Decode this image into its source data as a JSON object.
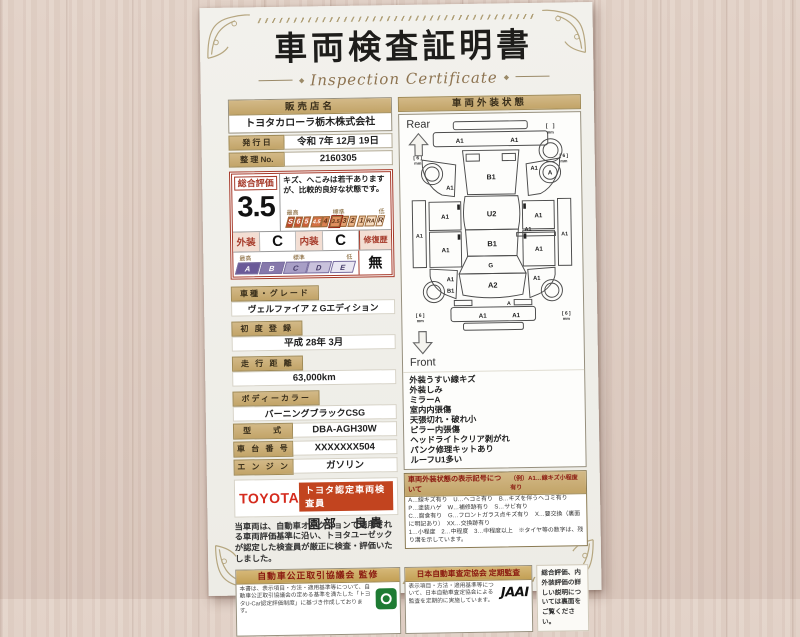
{
  "page": {
    "title_ja": "車両検査証明書",
    "title_en": "Inspection Certificate",
    "ornament": "◆"
  },
  "seller": {
    "label": "販売店名",
    "name": "トヨタカローラ栃木株式会社"
  },
  "issue": {
    "label": "発 行 日",
    "value": "令和 7年 12月 19日"
  },
  "serial": {
    "label": "整 理 No.",
    "value": "2160305"
  },
  "rating": {
    "label": "総合評価",
    "score": "3.5",
    "comment": "キズ、へこみは若干ありますが、比較的良好な状態です。",
    "legend_high": "最高",
    "legend_mid": "標準",
    "legend_low": "低",
    "scale": [
      "S",
      "6",
      "5",
      "4.5",
      "4",
      "3.5",
      "3",
      "2",
      "1",
      "RA",
      "R"
    ],
    "selected": "3.5",
    "exterior_label": "外装",
    "exterior_grade": "C",
    "interior_label": "内装",
    "interior_grade": "C",
    "repair_label": "修復歴",
    "repair_value": "無",
    "grades": [
      "A",
      "B",
      "C",
      "D",
      "E"
    ]
  },
  "details": [
    {
      "label": "車種・グレード",
      "value": "ヴェルファイア Z Gエディション"
    },
    {
      "label": "初 度 登 録",
      "value": "平成 28年 3月"
    },
    {
      "label": "走 行 距 離",
      "value": "63,000km"
    },
    {
      "label": "ボディーカラー",
      "value": "バーニングブラックCSG"
    },
    {
      "label": "型　　式",
      "value": "DBA-AGH30W"
    },
    {
      "label": "車 台 番 号",
      "value": "XXXXXXX504"
    },
    {
      "label": "エ ン ジ ン",
      "value": "ガソリン"
    }
  ],
  "inspector": {
    "brand": "TOYOTA",
    "badge": "トヨタ認定車両検査員",
    "name": "園部　良貴"
  },
  "disclaimer": "当車両は、自動車オークションで適用される車両評価基準に沿い、トヨタユーゼックが認定した検査員が厳正に検査・評価いたしました。",
  "exterior_panel": {
    "header": "車両外装状態",
    "rear_label": "Rear",
    "front_label": "Front",
    "spare_tire_note": "[　]",
    "tire_note": "[ 6 ]",
    "mm": "mm",
    "labels": {
      "rear_bumper_left": "A1",
      "rear_bumper_right": "A1",
      "back_door": "B1",
      "left_quarter": "A1",
      "right_quarter": "A1",
      "rear_right_tire": "A",
      "left_sill": "A1",
      "left_door_rear": "A1",
      "left_door_front": "A1",
      "right_door_rear": "A1",
      "right_door_front": "A1",
      "right_sill": "A1",
      "side_molding": "A1",
      "roof": "U2",
      "roof_rear": "B1",
      "windshield": "G",
      "hood": "A2",
      "left_fender": "A1",
      "left_front_corner": "B1",
      "right_fender": "A1",
      "front_mark": "A",
      "front_bumper_left": "A1",
      "front_bumper_right": "A1"
    },
    "conditions": [
      "外装うすい線キズ",
      "外装しみ",
      "ミラーA",
      "室内内張傷",
      "天張切れ・破れ小",
      "ピラー内張傷",
      "ヘッドライトクリア剥がれ",
      "パンク修理キットあり",
      "ルーフU1多い"
    ],
    "legend": {
      "title": "車両外装状態の表示記号について",
      "example": "（例）A1…線キズ小程度有り",
      "lines": [
        "A…線キズ有り　U…ヘコミ有り　B…キズを伴うヘコミ有り　P…塗装ハゲ　W…補修跡有り　S…サビ有り",
        "C…腐食有り　G…フロントガラス点キズ有り　X…要交換（裏面に明記あり）　XX…交換跡有り",
        "1…小程度　2…中程度　3…中程度以上　※タイヤ等の数字は、残り溝を示しています。"
      ]
    }
  },
  "footer": {
    "fair_trade": {
      "title": "自動車公正取引協議会 監修",
      "body": "本書は、表示項目・方法・適用基準等について、自動車公正取引協議会の定める基準を満たした「トヨタU-Car認定評価制度」に基づき作成しております。"
    },
    "jaai": {
      "title": "日本自動車査定協会 定期監査",
      "body": "表示項目・方法・適用基準等について、日本自動車査定協会による監査を定期的に実施しています。",
      "logo": "JAAI"
    },
    "note": "総合評価、内外装評価の詳しい説明については裏面をご覧ください。"
  },
  "colors": {
    "accent_red": "#a63a2a",
    "toyota_red": "#d52b1e",
    "badge_orange": "#c2441f",
    "gold": "#c5a96f",
    "green_logo": "#1e7b33"
  }
}
